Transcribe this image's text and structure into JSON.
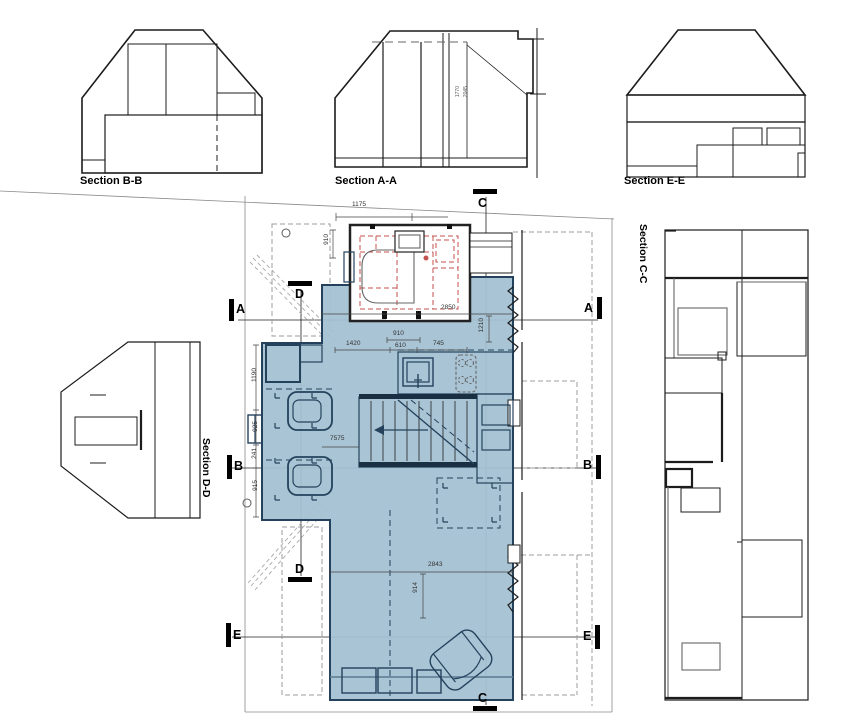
{
  "labels": {
    "section_bb": "Section B-B",
    "section_aa": "Section A-A",
    "section_ee": "Section E-E",
    "section_dd": "Section D-D",
    "section_cc": "Section C-C"
  },
  "markers": {
    "a": "A",
    "b": "B",
    "c": "C",
    "d": "D",
    "e": "E"
  },
  "dimensions": {
    "bath_width_top": "1175",
    "bath_depth": "910",
    "chain_left": "1420",
    "chain_door": "610",
    "chain_door_width": "910",
    "chain_right": "745",
    "plan_width": "2850",
    "right_depth": "1210",
    "hall_dim": "7575",
    "living_width": "2843",
    "living_depth": "914",
    "wall_seg_1": "1190",
    "wall_seg_2": "925",
    "wall_seg_3": "241",
    "wall_seg_4": "915",
    "section_a_dim_1": "1770",
    "section_a_dim_2": "2045"
  },
  "colors": {
    "plan_fill": "#a4c1d3",
    "wall_line": "#24425c",
    "demolition_red": "#c4524e",
    "dashed_gray": "#9c9c9c",
    "line_black": "#1c1c1c"
  }
}
